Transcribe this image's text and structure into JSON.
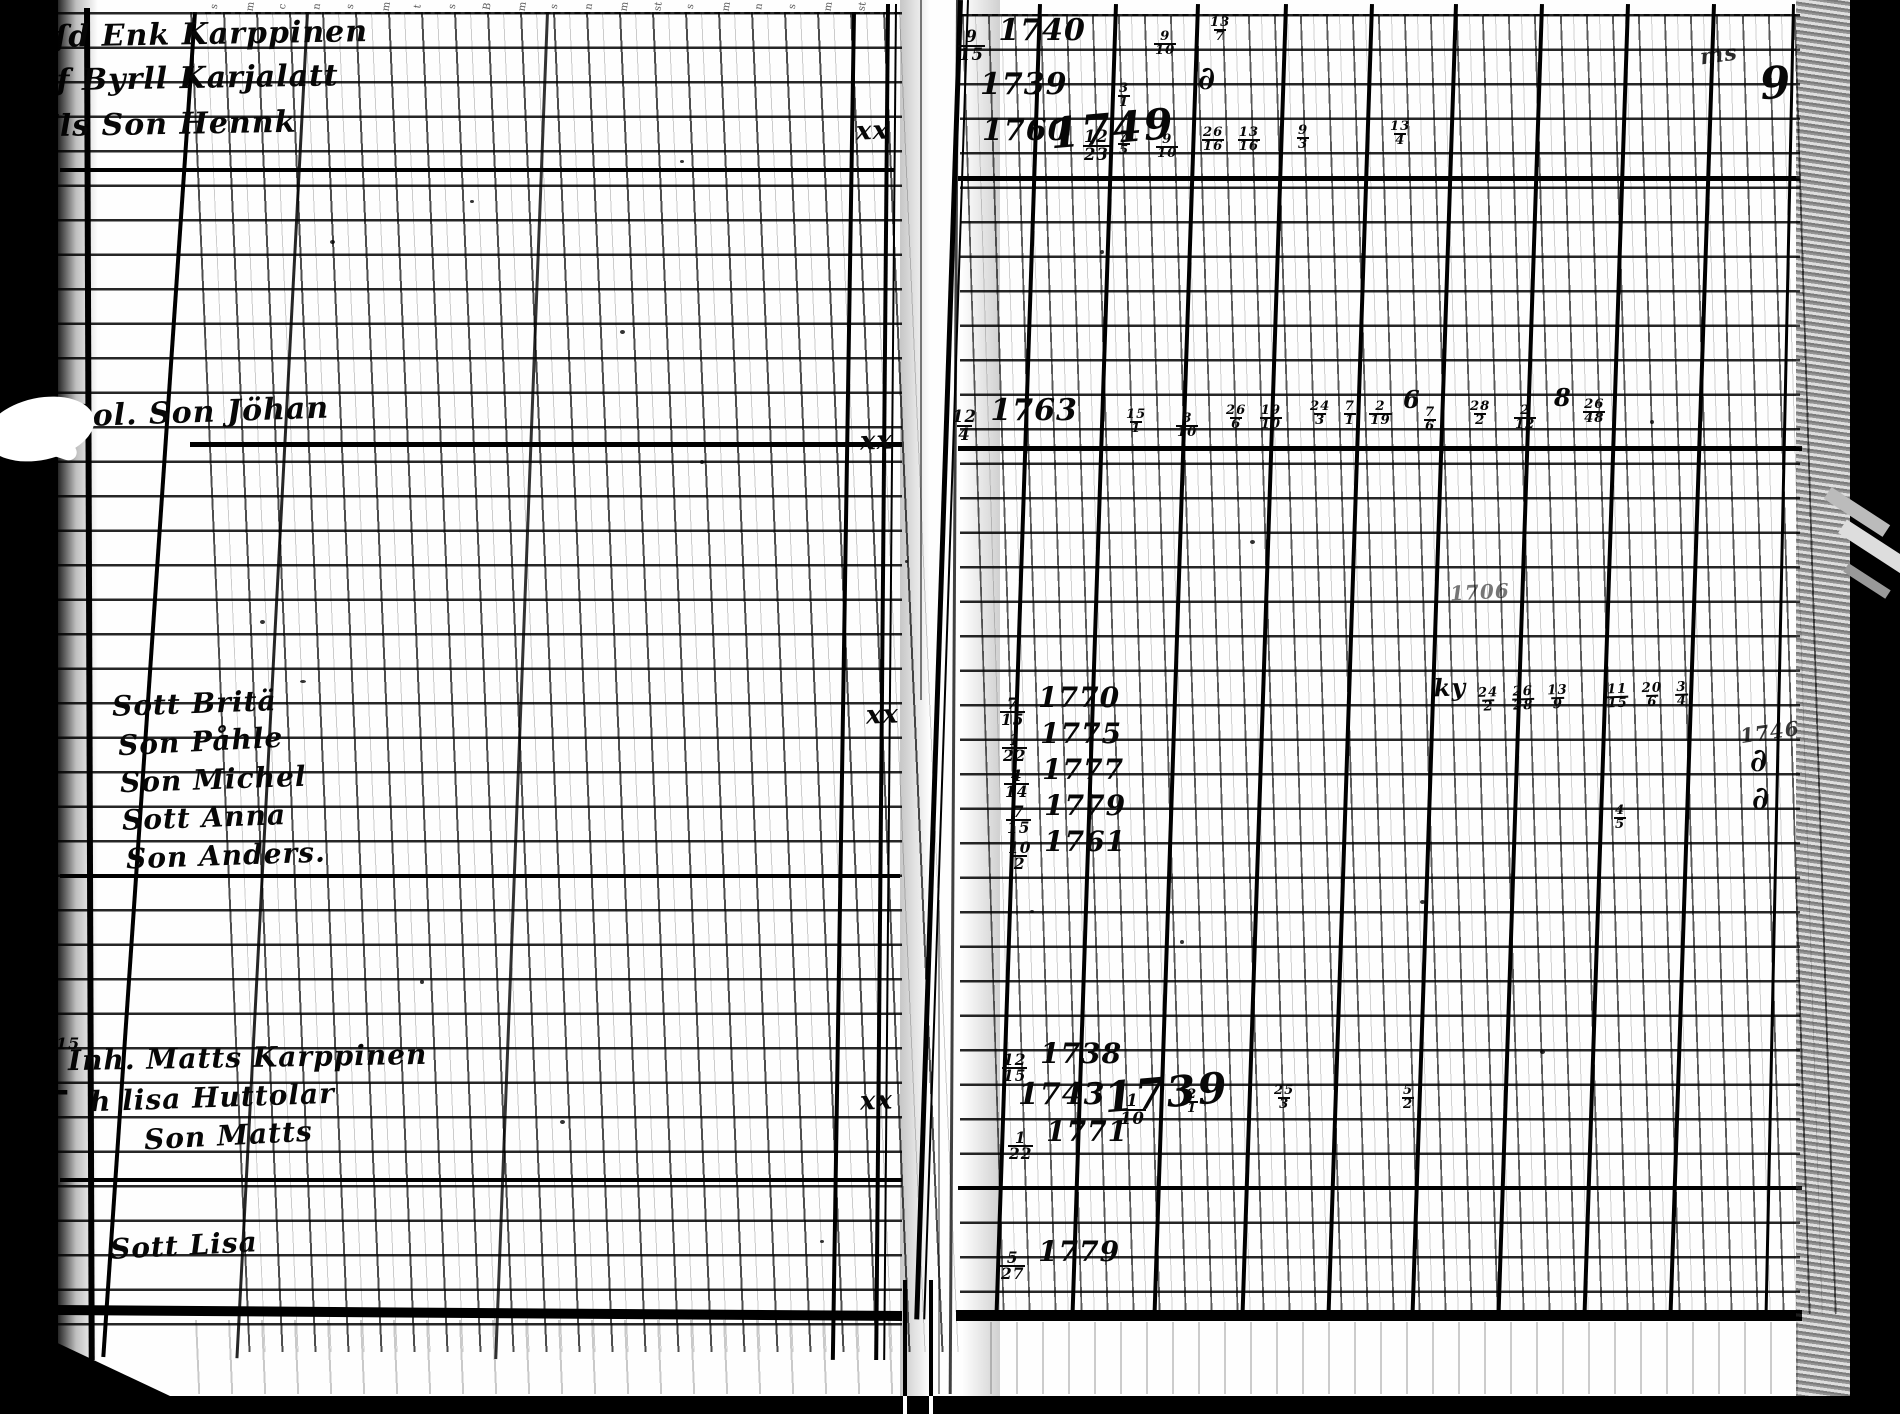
{
  "meta": {
    "description": "Scanned page spread of an 18th-century handwritten parish register with ruled grid columns",
    "paper_color": "#fefefe",
    "ink_color": "#070707",
    "scan_border_color": "#000000"
  },
  "header_glyphs": [
    {
      "x": 212,
      "g": "s"
    },
    {
      "x": 246,
      "g": "m"
    },
    {
      "x": 280,
      "g": "c"
    },
    {
      "x": 314,
      "g": "n"
    },
    {
      "x": 348,
      "g": "s"
    },
    {
      "x": 382,
      "g": "m"
    },
    {
      "x": 416,
      "g": "t"
    },
    {
      "x": 450,
      "g": "s"
    },
    {
      "x": 484,
      "g": "B"
    },
    {
      "x": 518,
      "g": "m"
    },
    {
      "x": 552,
      "g": "s"
    },
    {
      "x": 586,
      "g": "n"
    },
    {
      "x": 620,
      "g": "m"
    },
    {
      "x": 654,
      "g": "st"
    },
    {
      "x": 688,
      "g": "s"
    },
    {
      "x": 722,
      "g": "m"
    },
    {
      "x": 756,
      "g": "n"
    },
    {
      "x": 790,
      "g": "s"
    },
    {
      "x": 824,
      "g": "m"
    },
    {
      "x": 858,
      "g": "st"
    }
  ],
  "ink": [
    {
      "id": "name-enk-karppinen",
      "x": 36,
      "y": 20,
      "s": 30,
      "r": -1,
      "seg": [
        {
          "t": "yſd Enk Karppinen"
        }
      ]
    },
    {
      "id": "name-byrll-karjalatt",
      "x": 34,
      "y": 64,
      "s": 30,
      "r": -1,
      "seg": [
        {
          "t": "Yf Byrll Karjalatt"
        }
      ]
    },
    {
      "id": "name-son-hennk",
      "x": 36,
      "y": 110,
      "s": 30,
      "r": -1,
      "seg": [
        {
          "t": "Els Son Hennk"
        }
      ]
    },
    {
      "id": "name-son-johan",
      "x": 70,
      "y": 398,
      "s": 30,
      "r": -2,
      "seg": [
        {
          "t": "Sol. Son Jöhan"
        }
      ]
    },
    {
      "id": "name-sott-brita",
      "x": 112,
      "y": 690,
      "s": 28,
      "r": -2,
      "seg": [
        {
          "t": "Sott Britä"
        }
      ]
    },
    {
      "id": "name-son-pahle",
      "x": 118,
      "y": 728,
      "s": 28,
      "r": -3,
      "seg": [
        {
          "t": "Son Påhle"
        }
      ]
    },
    {
      "id": "name-son-michel",
      "x": 120,
      "y": 766,
      "s": 28,
      "r": -2,
      "seg": [
        {
          "t": "Son Michel"
        }
      ]
    },
    {
      "id": "name-sott-anna",
      "x": 122,
      "y": 804,
      "s": 28,
      "r": -2,
      "seg": [
        {
          "t": "Sott Anna"
        }
      ]
    },
    {
      "id": "name-son-anders",
      "x": 126,
      "y": 842,
      "s": 28,
      "r": -2,
      "seg": [
        {
          "t": "Son Anders."
        }
      ]
    },
    {
      "id": "name-matts-karppinen",
      "x": 68,
      "y": 1044,
      "s": 28,
      "r": -1,
      "seg": [
        {
          "t": "Inh. Matts Karppinen"
        }
      ]
    },
    {
      "id": "name-lisa-huttolar",
      "x": 90,
      "y": 1084,
      "s": 28,
      "r": -2,
      "seg": [
        {
          "t": "h lisa Huttolar"
        }
      ]
    },
    {
      "id": "name-son-matts",
      "x": 144,
      "y": 1122,
      "s": 28,
      "r": -3,
      "seg": [
        {
          "t": "Son Matts"
        }
      ]
    },
    {
      "id": "name-sott-lisa",
      "x": 110,
      "y": 1232,
      "s": 28,
      "r": -3,
      "seg": [
        {
          "t": "Sott Lisa"
        }
      ]
    },
    {
      "id": "xx-mark-1",
      "x": 856,
      "y": 118,
      "s": 26,
      "r": -2,
      "seg": [
        {
          "t": "xx"
        }
      ]
    },
    {
      "id": "xx-mark-2",
      "x": 860,
      "y": 428,
      "s": 26,
      "r": -2,
      "seg": [
        {
          "t": "xx"
        }
      ]
    },
    {
      "id": "xx-mark-3",
      "x": 866,
      "y": 702,
      "s": 26,
      "r": -2,
      "seg": [
        {
          "t": "xx"
        }
      ]
    },
    {
      "id": "xx-mark-4",
      "x": 860,
      "y": 1088,
      "s": 26,
      "r": -2,
      "seg": [
        {
          "t": "xx"
        }
      ]
    },
    {
      "id": "margin-y-mark",
      "x": 24,
      "y": 694,
      "s": 40,
      "r": -8,
      "seg": [
        {
          "t": "y"
        }
      ]
    },
    {
      "id": "margin-cross",
      "x": 38,
      "y": 1072,
      "s": 40,
      "seg": [
        {
          "t": "+"
        }
      ]
    },
    {
      "id": "margin-note-15",
      "x": 56,
      "y": 1036,
      "s": 16,
      "seg": [
        {
          "t": "15"
        }
      ]
    },
    {
      "id": "margin-curl-1",
      "x": 34,
      "y": 726,
      "s": 30,
      "seg": [
        {
          "t": "∂"
        }
      ]
    },
    {
      "id": "margin-curl-2",
      "x": 34,
      "y": 786,
      "s": 30,
      "seg": [
        {
          "t": "∂"
        }
      ]
    },
    {
      "id": "margin-curl-3",
      "x": 34,
      "y": 840,
      "s": 30,
      "seg": [
        {
          "t": "∂"
        }
      ]
    },
    {
      "id": "date-1740",
      "x": 956,
      "y": 16,
      "s": 30,
      "seg": [
        {
          "n": "9",
          "d": "15"
        },
        {
          "t": " 1740"
        }
      ]
    },
    {
      "id": "date-1739",
      "x": 980,
      "y": 70,
      "s": 30,
      "seg": [
        {
          "t": "1739"
        }
      ]
    },
    {
      "id": "date-1760",
      "x": 982,
      "y": 116,
      "s": 30,
      "seg": [
        {
          "t": "1760 "
        },
        {
          "n": "12",
          "d": "23"
        }
      ]
    },
    {
      "id": "date-1749-big",
      "x": 1050,
      "y": 108,
      "s": 42,
      "r": -5,
      "c": "big",
      "seg": [
        {
          "t": "1749"
        }
      ]
    },
    {
      "id": "date-1763",
      "x": 950,
      "y": 396,
      "s": 30,
      "seg": [
        {
          "n": "12",
          "d": "4"
        },
        {
          "t": " 1763"
        }
      ]
    },
    {
      "id": "date-1770",
      "x": 998,
      "y": 684,
      "s": 28,
      "seg": [
        {
          "n": "7",
          "d": "15"
        },
        {
          "t": " 1770"
        }
      ]
    },
    {
      "id": "date-1775",
      "x": 1000,
      "y": 720,
      "s": 28,
      "seg": [
        {
          "n": "1",
          "d": "22"
        },
        {
          "t": " 1775"
        }
      ]
    },
    {
      "id": "date-1777",
      "x": 1002,
      "y": 756,
      "s": 28,
      "seg": [
        {
          "n": "4",
          "d": "14"
        },
        {
          "t": " 1777"
        }
      ]
    },
    {
      "id": "date-1779",
      "x": 1004,
      "y": 792,
      "s": 28,
      "seg": [
        {
          "n": "7",
          "d": "15"
        },
        {
          "t": " 1779"
        }
      ]
    },
    {
      "id": "date-1761",
      "x": 1006,
      "y": 828,
      "s": 28,
      "seg": [
        {
          "n": "10",
          "d": "2"
        },
        {
          "t": " 1761"
        }
      ]
    },
    {
      "id": "date-1738",
      "x": 1000,
      "y": 1040,
      "s": 28,
      "seg": [
        {
          "n": "12",
          "d": "15"
        },
        {
          "t": " 1738"
        }
      ]
    },
    {
      "id": "date-1743",
      "x": 1018,
      "y": 1080,
      "s": 30,
      "seg": [
        {
          "t": "1743 "
        },
        {
          "n": "1",
          "d": "10"
        }
      ]
    },
    {
      "id": "date-1739-big",
      "x": 1104,
      "y": 1072,
      "s": 42,
      "r": -5,
      "c": "big",
      "seg": [
        {
          "t": "1739"
        }
      ]
    },
    {
      "id": "date-1771",
      "x": 1006,
      "y": 1118,
      "s": 28,
      "seg": [
        {
          "n": "1",
          "d": "22"
        },
        {
          "t": " 1771"
        }
      ]
    },
    {
      "id": "date-1779-b",
      "x": 998,
      "y": 1238,
      "s": 28,
      "seg": [
        {
          "n": "5",
          "d": "27"
        },
        {
          "t": " 1779"
        }
      ]
    },
    {
      "id": "frac-r1-a",
      "x": 1152,
      "y": 18,
      "s": 24,
      "seg": [
        {
          "n": "9",
          "d": "10"
        }
      ]
    },
    {
      "id": "frac-r1-b",
      "x": 1208,
      "y": 4,
      "s": 24,
      "seg": [
        {
          "n": "13",
          "d": "7"
        }
      ]
    },
    {
      "id": "frac-r2-a",
      "x": 1116,
      "y": 70,
      "s": 24,
      "seg": [
        {
          "n": "3",
          "d": "1"
        }
      ]
    },
    {
      "id": "curl-r2",
      "x": 1198,
      "y": 62,
      "s": 32,
      "seg": [
        {
          "t": "∂"
        }
      ]
    },
    {
      "id": "frac-r3-a",
      "x": 1116,
      "y": 118,
      "s": 24,
      "seg": [
        {
          "n": "7",
          "d": "5"
        }
      ]
    },
    {
      "id": "frac-r3-b",
      "x": 1154,
      "y": 121,
      "s": 24,
      "seg": [
        {
          "n": "9",
          "d": "10"
        }
      ]
    },
    {
      "id": "frac-r3-c",
      "x": 1200,
      "y": 114,
      "s": 24,
      "seg": [
        {
          "n": "26",
          "d": "16"
        },
        {
          "t": " "
        },
        {
          "n": "13",
          "d": "16"
        }
      ]
    },
    {
      "id": "frac-r3-d",
      "x": 1295,
      "y": 112,
      "s": 24,
      "seg": [
        {
          "n": "9",
          "d": "3"
        }
      ]
    },
    {
      "id": "frac-r3-e",
      "x": 1388,
      "y": 108,
      "s": 24,
      "seg": [
        {
          "n": "13",
          "d": "4"
        }
      ]
    },
    {
      "id": "frac-r4-a",
      "x": 1124,
      "y": 396,
      "s": 24,
      "seg": [
        {
          "n": "15",
          "d": "1"
        }
      ]
    },
    {
      "id": "frac-r4-b",
      "x": 1174,
      "y": 400,
      "s": 24,
      "seg": [
        {
          "n": "8",
          "d": "10"
        }
      ]
    },
    {
      "id": "frac-r4-c",
      "x": 1224,
      "y": 392,
      "s": 24,
      "seg": [
        {
          "n": "26",
          "d": "6"
        },
        {
          "t": " "
        },
        {
          "n": "19",
          "d": "10"
        }
      ]
    },
    {
      "id": "frac-r4-d",
      "x": 1308,
      "y": 388,
      "s": 24,
      "seg": [
        {
          "n": "24",
          "d": "3"
        },
        {
          "t": " "
        },
        {
          "n": "7",
          "d": "1"
        },
        {
          "t": " "
        },
        {
          "n": "2",
          "d": "19"
        },
        {
          "t": " 6"
        }
      ]
    },
    {
      "id": "frac-r4-e",
      "x": 1422,
      "y": 394,
      "s": 24,
      "seg": [
        {
          "n": "7",
          "d": "6"
        }
      ]
    },
    {
      "id": "frac-r4-f",
      "x": 1468,
      "y": 388,
      "s": 24,
      "seg": [
        {
          "n": "28",
          "d": "2"
        }
      ]
    },
    {
      "id": "frac-r4-g",
      "x": 1512,
      "y": 392,
      "s": 24,
      "seg": [
        {
          "n": "2",
          "d": "12"
        }
      ]
    },
    {
      "id": "frac-r4-h",
      "x": 1554,
      "y": 386,
      "s": 24,
      "seg": [
        {
          "t": "8 "
        },
        {
          "n": "26",
          "d": "48"
        }
      ]
    },
    {
      "id": "note-ky",
      "x": 1434,
      "y": 674,
      "s": 24,
      "r": -2,
      "seg": [
        {
          "t": "ky "
        },
        {
          "n": "24",
          "d": "2"
        },
        {
          "t": " "
        },
        {
          "n": "26",
          "d": "28"
        },
        {
          "t": " "
        },
        {
          "n": "13",
          "d": "9"
        }
      ]
    },
    {
      "id": "note-cluster2",
      "x": 1604,
      "y": 670,
      "s": 24,
      "r": -2,
      "seg": [
        {
          "n": "11",
          "d": "15"
        },
        {
          "t": " "
        },
        {
          "n": "20",
          "d": "6"
        },
        {
          "t": " "
        },
        {
          "n": "3",
          "d": "4"
        }
      ]
    },
    {
      "id": "frac-45",
      "x": 1612,
      "y": 792,
      "s": 24,
      "seg": [
        {
          "n": "4",
          "d": "5"
        }
      ]
    },
    {
      "id": "note-1706",
      "x": 1450,
      "y": 582,
      "s": 20,
      "r": -3,
      "f": 0.55,
      "seg": [
        {
          "t": "1706"
        }
      ]
    },
    {
      "id": "note-1746",
      "x": 1740,
      "y": 722,
      "s": 20,
      "r": -8,
      "f": 0.8,
      "seg": [
        {
          "t": "1746"
        }
      ]
    },
    {
      "id": "edge-curl-1",
      "x": 1750,
      "y": 744,
      "s": 32,
      "seg": [
        {
          "t": "∂"
        }
      ]
    },
    {
      "id": "edge-curl-2",
      "x": 1752,
      "y": 782,
      "s": 32,
      "seg": [
        {
          "t": "∂"
        }
      ]
    },
    {
      "id": "edge-squiggle",
      "x": 1700,
      "y": 44,
      "s": 22,
      "r": -8,
      "f": 0.85,
      "seg": [
        {
          "t": "ms"
        }
      ]
    },
    {
      "id": "edge-nine",
      "x": 1760,
      "y": 62,
      "s": 44,
      "r": -5,
      "seg": [
        {
          "t": "9"
        }
      ]
    },
    {
      "id": "frac-b1",
      "x": 1184,
      "y": 1076,
      "s": 24,
      "seg": [
        {
          "n": "2",
          "d": "1"
        }
      ]
    },
    {
      "id": "frac-b2",
      "x": 1272,
      "y": 1072,
      "s": 24,
      "seg": [
        {
          "n": "25",
          "d": "3"
        }
      ]
    },
    {
      "id": "frac-b3",
      "x": 1400,
      "y": 1072,
      "s": 24,
      "seg": [
        {
          "n": "5",
          "d": "2"
        }
      ]
    }
  ],
  "specks": [
    {
      "x": 330,
      "y": 240,
      "w": 5,
      "h": 4
    },
    {
      "x": 470,
      "y": 200,
      "w": 4,
      "h": 3
    },
    {
      "x": 620,
      "y": 330,
      "w": 5,
      "h": 4
    },
    {
      "x": 700,
      "y": 460,
      "w": 4,
      "h": 4
    },
    {
      "x": 260,
      "y": 620,
      "w": 5,
      "h": 4
    },
    {
      "x": 420,
      "y": 980,
      "w": 4,
      "h": 4
    },
    {
      "x": 560,
      "y": 1120,
      "w": 5,
      "h": 4
    },
    {
      "x": 300,
      "y": 680,
      "w": 6,
      "h": 3
    },
    {
      "x": 1100,
      "y": 250,
      "w": 4,
      "h": 4
    },
    {
      "x": 1250,
      "y": 540,
      "w": 5,
      "h": 4
    },
    {
      "x": 1420,
      "y": 900,
      "w": 5,
      "h": 4
    },
    {
      "x": 1650,
      "y": 420,
      "w": 4,
      "h": 4
    },
    {
      "x": 1540,
      "y": 1050,
      "w": 5,
      "h": 4
    },
    {
      "x": 680,
      "y": 160,
      "w": 4,
      "h": 3
    },
    {
      "x": 905,
      "y": 560,
      "w": 3,
      "h": 3
    },
    {
      "x": 1180,
      "y": 940,
      "w": 4,
      "h": 4
    },
    {
      "x": 820,
      "y": 1240,
      "w": 4,
      "h": 3
    },
    {
      "x": 1030,
      "y": 910,
      "w": 4,
      "h": 3
    }
  ]
}
